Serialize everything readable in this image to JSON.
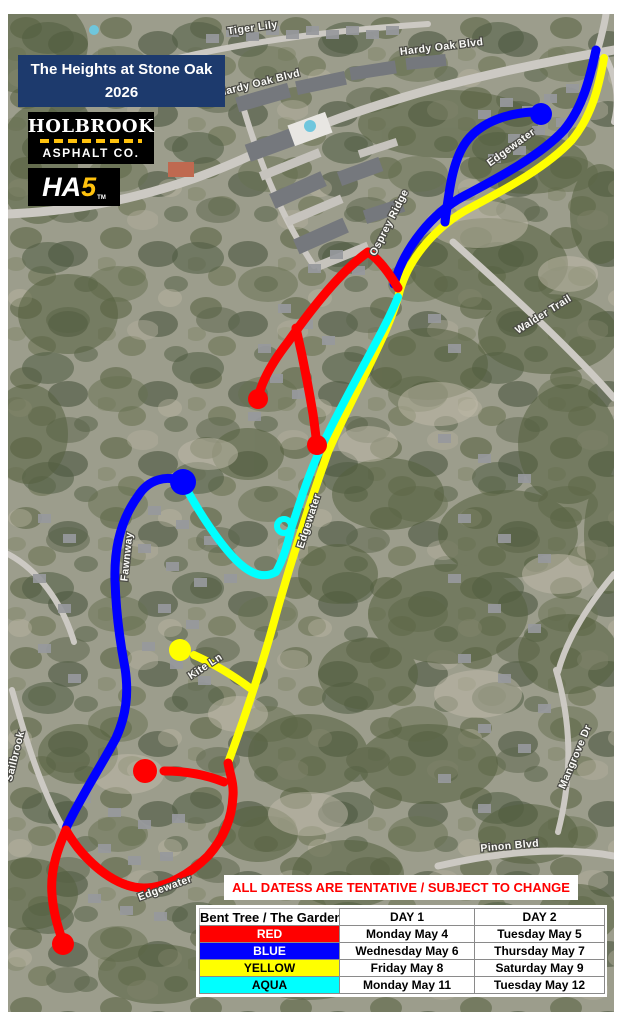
{
  "title_block": {
    "line1": "The Heights at Stone Oak",
    "line2": "2026",
    "bg_color": "#1d3a6d"
  },
  "logos": {
    "holbrook": {
      "line1": "HOLBROOK",
      "line2": "ASPHALT CO.",
      "accent_color": "#ffc20e"
    },
    "ha5": {
      "prefix": "HA",
      "suffix": "5",
      "tm": "TM"
    }
  },
  "map": {
    "street_labels": [
      {
        "text": "Tiger Lily"
      },
      {
        "text": "Hardy Oak Blvd"
      },
      {
        "text": "Hardy Oak Blvd"
      },
      {
        "text": "Edgewater"
      },
      {
        "text": "Osprey Ridge"
      },
      {
        "text": "Walder Trail"
      },
      {
        "text": "Edgewater"
      },
      {
        "text": "Fawnway"
      },
      {
        "text": "Kite Ln"
      },
      {
        "text": "Mangrove Dr"
      },
      {
        "text": "Pinon Blvd"
      },
      {
        "text": "Sailbrook"
      },
      {
        "text": "Edgewater"
      }
    ]
  },
  "routes": {
    "red": "#FF0000",
    "blue": "#0000FF",
    "yellow": "#FFFF00",
    "aqua": "#00FFFF"
  },
  "notice": {
    "text": "ALL DATESS ARE TENTATIVE / SUBJECT TO CHANGE",
    "color": "#FF0000"
  },
  "schedule_table": {
    "area_header": "Bent Tree / The Gardens",
    "columns": [
      "DAY 1",
      "DAY 2"
    ],
    "rows": [
      {
        "label": "RED",
        "color": "#FF0000",
        "text_color": "#FFFFFF",
        "day1": "Monday May 4",
        "day2": "Tuesday May 5"
      },
      {
        "label": "BLUE",
        "color": "#0000FF",
        "text_color": "#FFFFFF",
        "day1": "Wednesday May 6",
        "day2": "Thursday May 7"
      },
      {
        "label": "YELLOW",
        "color": "#FFFF00",
        "text_color": "#000000",
        "day1": "Friday May 8",
        "day2": "Saturday May 9"
      },
      {
        "label": "AQUA",
        "color": "#00FFFF",
        "text_color": "#000000",
        "day1": "Monday May 11",
        "day2": "Tuesday May 12"
      }
    ]
  }
}
